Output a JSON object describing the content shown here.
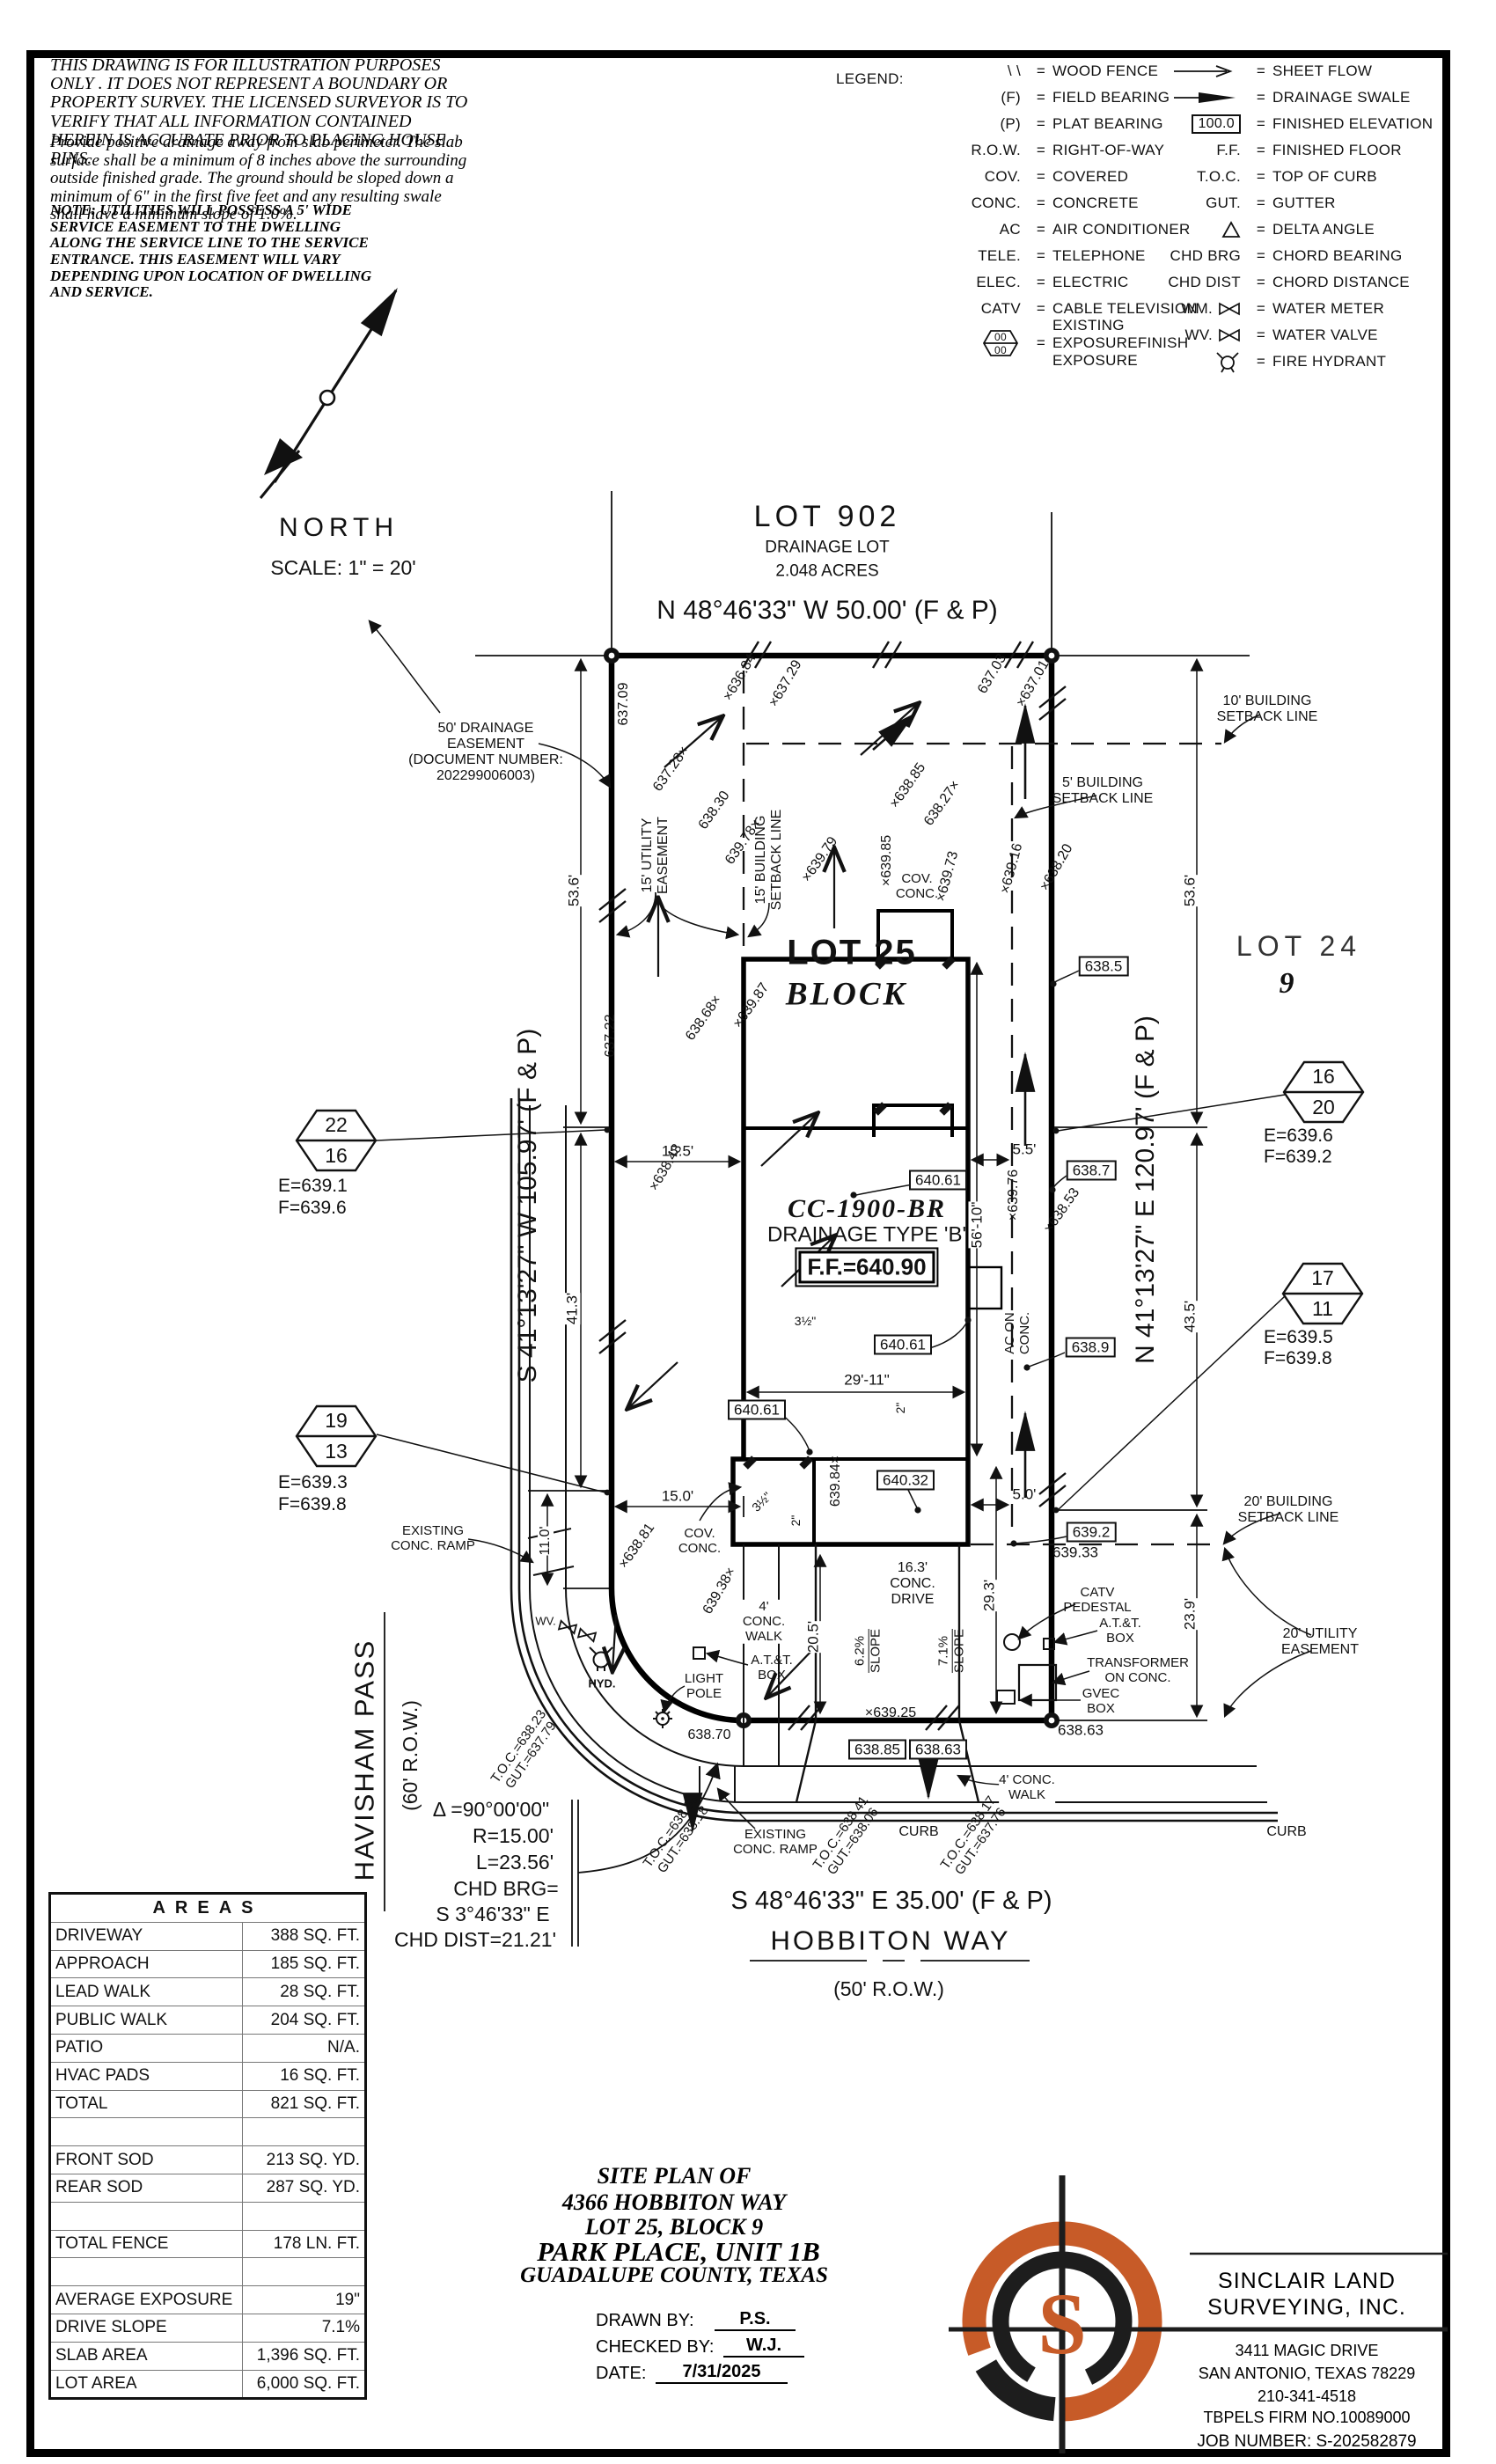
{
  "disclaimer": {
    "p1": "THIS DRAWING IS FOR ILLUSTRATION PURPOSES ONLY . IT DOES NOT REPRESENT A BOUNDARY OR PROPERTY SURVEY. THE LICENSED SURVEYOR IS TO VERIFY THAT ALL INFORMATION CONTAINED HEREIN IS ACCURATE PRIOR TO PLACING HOUSE PINS.",
    "p2": "Provide positive drainage away from slab perimeter. The slab surface shall be a minimum of 8 inches above the surrounding outside finished grade. The ground should be sloped down a minimum of 6\" in the first five feet and any resulting swale shall have a minimum slope of 1.0%.",
    "note": "NOTE: UTILITIES WILL POSSESS A 5' WIDE SERVICE EASEMENT TO THE DWELLING ALONG THE SERVICE LINE TO THE SERVICE ENTRANCE. THIS EASEMENT WILL VARY DEPENDING UPON LOCATION OF DWELLING AND SERVICE."
  },
  "legend": {
    "title": "LEGEND:",
    "eq": "=",
    "left": [
      {
        "sym": "\\ \\",
        "text": "WOOD FENCE"
      },
      {
        "sym": "(F)",
        "text": "FIELD BEARING"
      },
      {
        "sym": "(P)",
        "text": "PLAT BEARING"
      },
      {
        "sym": "R.O.W.",
        "text": "RIGHT-OF-WAY"
      },
      {
        "sym": "COV.",
        "text": "COVERED"
      },
      {
        "sym": "CONC.",
        "text": "CONCRETE"
      },
      {
        "sym": "AC",
        "text": "AIR CONDITIONER"
      },
      {
        "sym": "TELE.",
        "text": "TELEPHONE"
      },
      {
        "sym": "ELEC.",
        "text": "ELECTRIC"
      },
      {
        "sym": "CATV",
        "text": "CABLE TELEVISION"
      },
      {
        "hex_top": "00",
        "hex_bottom": "00",
        "text1": "EXISTING EXPOSURE",
        "text2": "FINISH EXPOSURE"
      }
    ],
    "right": [
      {
        "icon": "sheet-flow-arrow",
        "text": "SHEET FLOW"
      },
      {
        "icon": "drainage-swale-arrow",
        "text": "DRAINAGE SWALE"
      },
      {
        "sym": "100.0",
        "text": "FINISHED ELEVATION"
      },
      {
        "sym": "F.F.",
        "text": "FINISHED FLOOR"
      },
      {
        "sym": "T.O.C.",
        "text": "TOP OF CURB"
      },
      {
        "sym": "GUT.",
        "text": "GUTTER"
      },
      {
        "icon": "delta-triangle",
        "text": "DELTA ANGLE"
      },
      {
        "sym": "CHD BRG",
        "text": "CHORD BEARING"
      },
      {
        "sym": "CHD DIST",
        "text": "CHORD DISTANCE"
      },
      {
        "sym": "WM.",
        "icon": "bowtie",
        "text": "WATER METER"
      },
      {
        "sym": "WV.",
        "icon": "bowtie",
        "text": "WATER VALVE"
      },
      {
        "icon": "fire-hydrant",
        "text": "FIRE HYDRANT"
      }
    ]
  },
  "north": {
    "label": "NORTH",
    "scale": "SCALE: 1\" = 20'"
  },
  "plan": {
    "lot902_title": "LOT 902",
    "lot902_sub1": "DRAINAGE LOT",
    "lot902_sub2": "2.048 ACRES",
    "brg_top": "N 48°46'33\" W 50.00' (F & P)",
    "brg_west": "S 41°13'27\" W 105.97' (F & P)",
    "brg_east": "N 41°13'27\" E 120.97' (F & P)",
    "brg_south": "S 48°46'33\" E 35.00' (F & P)",
    "hobbiton": "HOBBITON WAY",
    "hobbiton_row": "(50' R.O.W.)",
    "havisham": "HAVISHAM PASS",
    "havisham_row": "(60' R.O.W.)",
    "curve1": "Δ =90°00'00\"",
    "curve2": "R=15.00'",
    "curve3": "L=23.56'",
    "curve4": "CHD BRG=",
    "curve5": "S 3°46'33\" E",
    "curve6": "CHD DIST=21.21'",
    "lot25": "LOT 25",
    "block": "BLOCK",
    "lot24": "LOT 24",
    "lot24_blk": "9",
    "model": "CC-1900-BR",
    "dtype": "DRAINAGE TYPE 'B'",
    "ff": "F.F.=640.90",
    "de1": "50' DRAINAGE",
    "de2": "EASEMENT",
    "de3": "(DOCUMENT NUMBER:",
    "de4": "202299006003)",
    "ue15a": "15' UTILITY",
    "ue15b": "EASEMENT",
    "bsl15a": "15' BUILDING",
    "bsl15b": "SETBACK LINE",
    "bsl10a": "10' BUILDING",
    "bsl10b": "SETBACK LINE",
    "bsl5a": "5' BUILDING",
    "bsl5b": "SETBACK LINE",
    "bsl20a": "20' BUILDING",
    "bsl20b": "SETBACK LINE",
    "ue20a": "20' UTILITY",
    "ue20b": "EASEMENT",
    "aca": "AC ON",
    "acb": "CONC.",
    "covR1": "COV.",
    "covR2": "CONC.",
    "covF1": "COV.",
    "covF2": "CONC.",
    "ramp1a": "EXISTING",
    "ramp1b": "CONC. RAMP",
    "ramp2a": "EXISTING",
    "ramp2b": "CONC. RAMP",
    "light1": "LIGHT",
    "light2": "POLE",
    "lp_elev": "638.70",
    "attL1": "A.T.&T.",
    "attL2": "BOX",
    "attR1": "A.T.&T.",
    "attR2": "BOX",
    "catv1": "CATV",
    "catv2": "PEDESTAL",
    "xfmr1": "TRANSFORMER",
    "xfmr2": "ON CONC.",
    "gvec1": "GVEC",
    "gvec2": "BOX",
    "curb1": "CURB",
    "curb2": "CURB",
    "walkL1": "4'",
    "walkL2": "CONC.",
    "walkL3": "WALK",
    "walkR1": "4' CONC.",
    "walkR2": "WALK",
    "drive1": "16.3'",
    "drive2": "CONC.",
    "drive3": "DRIVE",
    "slope1a": "6.2%",
    "slope1b": "SLOPE",
    "slope2a": "7.1%",
    "slope2b": "SLOPE",
    "wv": "WV.",
    "hyd": "HYD.",
    "toc_a1": "T.O.C.=638.23",
    "toc_a2": "GUT.=637.79",
    "toc_b1": "T.O.C.=638.33",
    "toc_b2": "GUT.=638.18",
    "toc_c1": "T.O.C.=638.41",
    "toc_c2": "GUT.=638.06",
    "toc_d1": "T.O.C.=638.17",
    "toc_d2": "GUT.=637.76",
    "hex1t": "22",
    "hex1b": "16",
    "hex1e": "E=639.1",
    "hex1f": "F=639.6",
    "hex2t": "19",
    "hex2b": "13",
    "hex2e": "E=639.3",
    "hex2f": "F=639.8",
    "hex3t": "16",
    "hex3b": "20",
    "hex3e": "E=639.6",
    "hex3f": "F=639.2",
    "hex4t": "17",
    "hex4b": "11",
    "hex4e": "E=639.5",
    "hex4f": "F=639.8",
    "bx640a": "640.61",
    "bx640b": "640.61",
    "bx640c": "640.61",
    "bx640d": "640.32",
    "bx6385": "638.5",
    "bx6387": "638.7",
    "bx6389": "638.9",
    "bx6392": "639.2",
    "bx63885": "638.85",
    "bx63863": "638.63",
    "e639_33": "639.33",
    "e638_63": "638.63",
    "e639_25": "×639.25",
    "d15_5": "15.5'",
    "d5_5": "5.5'",
    "d15_0": "15.0'",
    "d5_0": "5.0'",
    "d56_10": "56'-10\"",
    "d29_11": "29'-11\"",
    "d53_6L": "53.6'",
    "d41_3": "41.3'",
    "d11_0": "11.0'",
    "d53_6R": "53.6'",
    "d43_5": "43.5'",
    "d23_9": "23.9'",
    "d29_3": "29.3'",
    "d20_5": "20.5'",
    "d3h_a": "3½\"",
    "d2_a": "2\"",
    "d3h_b": "3½\"",
    "d2_b": "2\"",
    "sp_637_09": "637.09",
    "sp_637_28": "637.28×",
    "sp_638_30": "638.30",
    "sp_636_84": "×636.84",
    "sp_637_29": "×637.29",
    "sp_637_03": "637.03",
    "sp_637_01": "×637.01",
    "sp_638_85": "×638.85",
    "sp_638_27": "638.27×",
    "sp_639_78": "639.78×",
    "sp_639_79": "×639.79",
    "sp_639_85": "×639.85",
    "sp_639_73": "×639.73",
    "sp_639_16": "×639.16",
    "sp_638_20": "×638.20",
    "sp_637_22": "637.22",
    "sp_638_68": "638.68×",
    "sp_639_87": "×639.87",
    "sp_638_43": "×638.43",
    "sp_639_76": "×639.76",
    "sp_638_53": "×638.53",
    "sp_638_81": "×638.81",
    "sp_639_38": "639.38×",
    "sp_639_84": "639.84×"
  },
  "areas": {
    "title": "AREAS",
    "rows": [
      {
        "label": "DRIVEWAY",
        "value": "388 SQ. FT."
      },
      {
        "label": "APPROACH",
        "value": "185 SQ. FT."
      },
      {
        "label": "LEAD WALK",
        "value": "28 SQ. FT."
      },
      {
        "label": "PUBLIC WALK",
        "value": "204 SQ. FT."
      },
      {
        "label": "PATIO",
        "value": "N/A."
      },
      {
        "label": "HVAC PADS",
        "value": "16 SQ. FT."
      },
      {
        "label": "TOTAL",
        "value": "821 SQ. FT."
      },
      {
        "label": "",
        "value": ""
      },
      {
        "label": "FRONT SOD",
        "value": "213 SQ. YD."
      },
      {
        "label": "REAR SOD",
        "value": "287 SQ. YD."
      },
      {
        "label": "",
        "value": ""
      },
      {
        "label": "TOTAL FENCE",
        "value": "178 LN. FT."
      },
      {
        "label": "",
        "value": ""
      },
      {
        "label": "AVERAGE EXPOSURE",
        "value": "19\""
      },
      {
        "label": "DRIVE SLOPE",
        "value": "7.1%"
      },
      {
        "label": "SLAB AREA",
        "value": "1,396 SQ. FT."
      },
      {
        "label": "LOT AREA",
        "value": "6,000 SQ. FT."
      }
    ]
  },
  "titleblock": {
    "l1": "SITE PLAN OF",
    "l2": "4366 HOBBITON WAY",
    "l3": "LOT 25, BLOCK 9",
    "l4": "PARK PLACE, UNIT 1B",
    "l5": "GUADALUPE COUNTY, TEXAS",
    "drawn_label": "DRAWN BY:",
    "drawn": "P.S.",
    "checked_label": "CHECKED BY:",
    "checked": "W.J.",
    "date_label": "DATE:",
    "date": "7/31/2025"
  },
  "company": {
    "logo_letter": "S",
    "name1": "SINCLAIR LAND",
    "name2": "SURVEYING, INC.",
    "addr1": "3411 MAGIC DRIVE",
    "addr2": "SAN ANTONIO, TEXAS 78229",
    "phone": "210-341-4518",
    "firm": "TBPELS FIRM NO.10089000",
    "job": "JOB NUMBER: S-202582879",
    "accent": "#C75B28"
  }
}
